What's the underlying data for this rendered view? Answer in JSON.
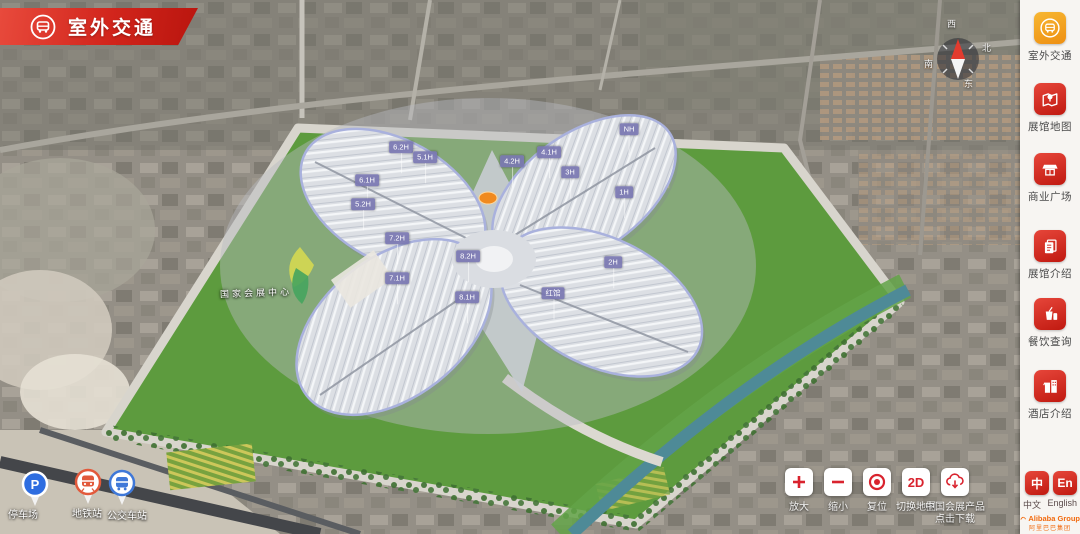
{
  "banner": {
    "title": "室外交通"
  },
  "sidebar": {
    "items": [
      {
        "label": "室外交通",
        "icon": "bus-icon",
        "active": true
      },
      {
        "label": "展馆地图",
        "icon": "map-pin-icon",
        "active": false
      },
      {
        "label": "商业广场",
        "icon": "storefront-icon",
        "active": false
      },
      {
        "label": "展馆介绍",
        "icon": "document-icon",
        "active": false
      },
      {
        "label": "餐饮查询",
        "icon": "drink-icon",
        "active": false
      },
      {
        "label": "酒店介绍",
        "icon": "hotel-icon",
        "active": false
      }
    ]
  },
  "controls": {
    "zoom_in": "放大",
    "zoom_out": "缩小",
    "reset": "复位",
    "map2d_button": "2D",
    "map2d": "切换地图",
    "download_line1": "中国会展产品",
    "download_line2": "点击下载"
  },
  "language": {
    "zh_button": "中",
    "en_button": "En",
    "zh_label": "中文",
    "en_label": "English"
  },
  "brand": {
    "name": "Alibaba Group",
    "cn": "阿里巴巴集团"
  },
  "legend": {
    "items": [
      {
        "label": "停车场"
      },
      {
        "label": "地铁站"
      },
      {
        "label": "公交车站"
      }
    ]
  },
  "compass": {
    "top": "西",
    "right": "北",
    "bottom": "东",
    "left": "南"
  },
  "map": {
    "site_sign": "国家会展中心",
    "hall_tags": [
      {
        "label": "6.2H",
        "x": 401,
        "y": 147
      },
      {
        "label": "5.1H",
        "x": 425,
        "y": 157
      },
      {
        "label": "6.1H",
        "x": 367,
        "y": 180
      },
      {
        "label": "5.2H",
        "x": 363,
        "y": 204
      },
      {
        "label": "7.2H",
        "x": 397,
        "y": 238
      },
      {
        "label": "7.1H",
        "x": 397,
        "y": 278
      },
      {
        "label": "8.2H",
        "x": 468,
        "y": 256
      },
      {
        "label": "8.1H",
        "x": 467,
        "y": 297
      },
      {
        "label": "4.2H",
        "x": 512,
        "y": 161
      },
      {
        "label": "4.1H",
        "x": 549,
        "y": 152
      },
      {
        "label": "3H",
        "x": 570,
        "y": 172
      },
      {
        "label": "NH",
        "x": 629,
        "y": 129
      },
      {
        "label": "1H",
        "x": 624,
        "y": 192
      },
      {
        "label": "2H",
        "x": 613,
        "y": 262
      },
      {
        "label": "红馆",
        "x": 553,
        "y": 293
      }
    ]
  }
}
